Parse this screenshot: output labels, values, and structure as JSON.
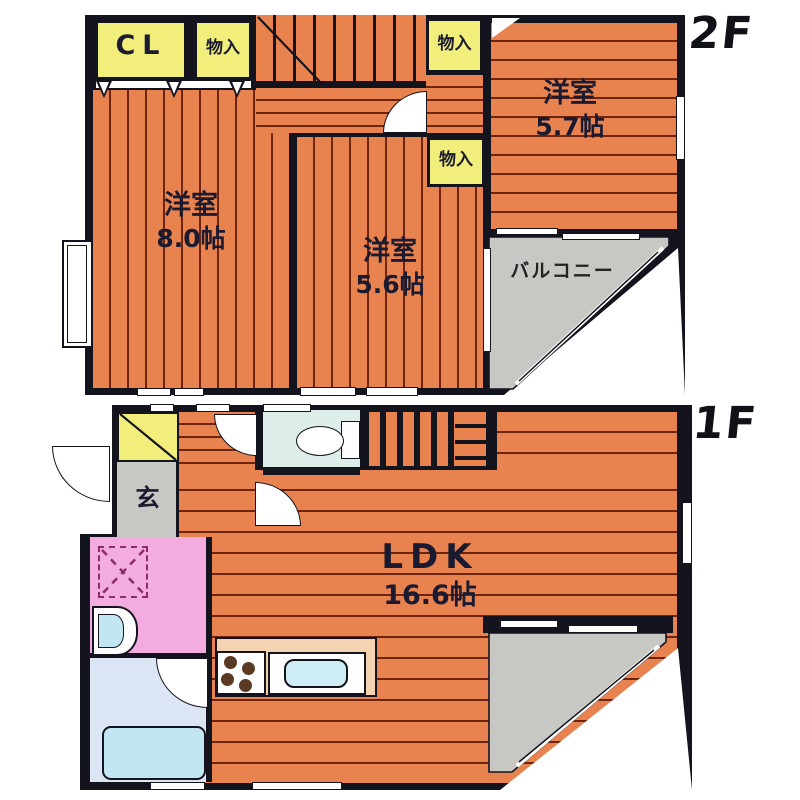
{
  "floor2": {
    "label": "2F",
    "closet": "CL",
    "storages": [
      "物入",
      "物入",
      "物入"
    ],
    "rooms": [
      {
        "name": "洋室",
        "size": "8.0帖"
      },
      {
        "name": "洋室",
        "size": "5.6帖"
      },
      {
        "name": "洋室",
        "size": "5.7帖"
      }
    ],
    "balcony": "バルコニー"
  },
  "floor1": {
    "label": "1F",
    "entrance": "玄",
    "room": {
      "name": "LDK",
      "size": "16.6帖"
    }
  },
  "colors": {
    "floor_orange": "#E8834F",
    "floor_line": "#6E2510",
    "wall_black": "#14141F",
    "storage_yellow": "#F2EE7B",
    "gray_area": "#C7C7C3",
    "washroom_pink": "#F3ACE0",
    "bath_blue": "#DBE5F3",
    "toilet_blue": "#DDEDE9",
    "fixture_cyan": "#C2E6F2",
    "counter_peach": "#F4D3B0",
    "text_dark": "#1A1A30"
  }
}
